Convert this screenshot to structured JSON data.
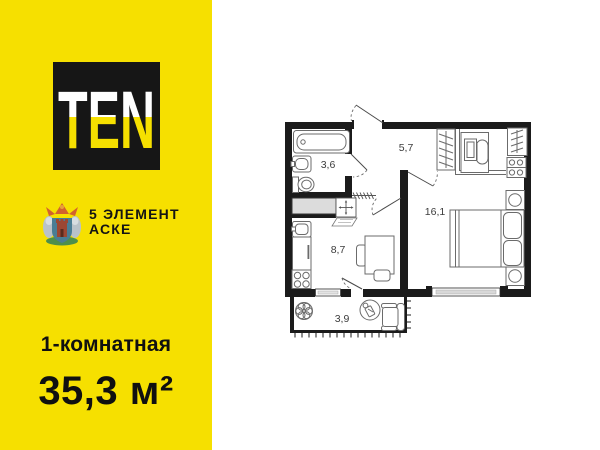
{
  "brand": {
    "logo_text": "TEN",
    "developer_name": "5 ЭЛЕМЕНТ",
    "developer_project": "АСКЕ"
  },
  "listing": {
    "type_label": "1-комнатная",
    "area_label": "35,3 м²"
  },
  "colors": {
    "accent_yellow": "#F6E000",
    "logo_black": "#161616"
  },
  "floor_plan": {
    "rooms": [
      {
        "name": "bathroom",
        "area": "3,6"
      },
      {
        "name": "hallway",
        "area": "5,7"
      },
      {
        "name": "bedroom",
        "area": "16,1"
      },
      {
        "name": "kitchen",
        "area": "8,7"
      },
      {
        "name": "balcony",
        "area": "3,9"
      }
    ]
  }
}
